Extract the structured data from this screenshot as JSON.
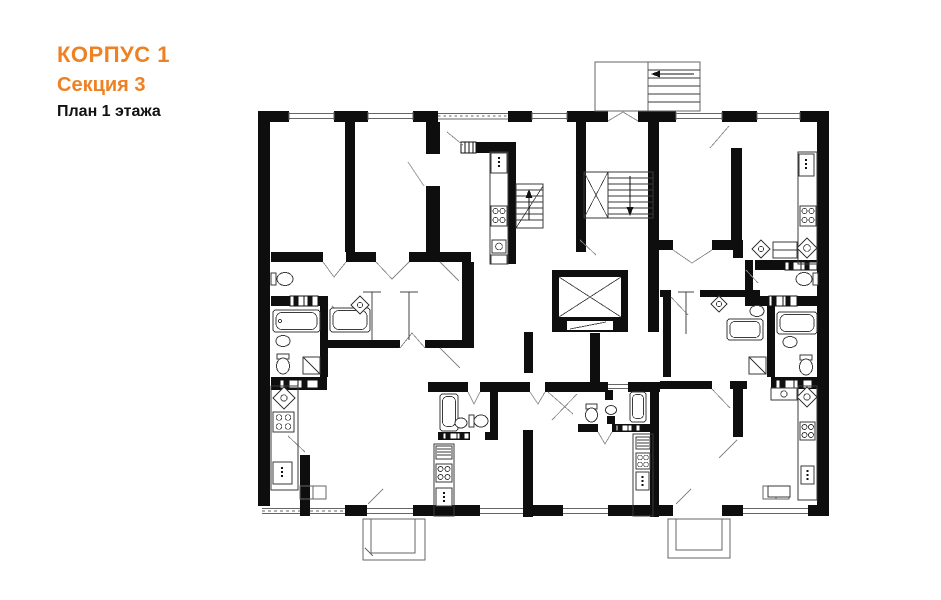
{
  "header": {
    "building": "КОРПУС 1",
    "section": "Секция 3",
    "floor": "План 1 этажа"
  },
  "colors": {
    "accent_orange": "#EE8124",
    "ink": "#111111",
    "wall_black": "#0E0E0E",
    "thin_line_gray": "#666666",
    "background": "#FFFFFF"
  },
  "plan_elements": {
    "entrance_porch": "entrance porch with exterior steps and direction arrow",
    "main_staircase": "interior staircase with landing and down arrow",
    "entry_staircase": "vestibule steps with up arrow",
    "elevator": "elevator shaft with crossed-diagonals car",
    "balcony_left": "lower-left balcony",
    "balcony_right": "lower-right balcony",
    "fixtures": [
      "bathtub",
      "toilet",
      "washbasin",
      "corner-sink",
      "shower-tray",
      "washing-machine",
      "stove-4-burner",
      "refrigerator",
      "kitchen-counter",
      "wardrobe",
      "vent-shaft-grille"
    ],
    "openings": [
      "window",
      "door-swing"
    ]
  }
}
